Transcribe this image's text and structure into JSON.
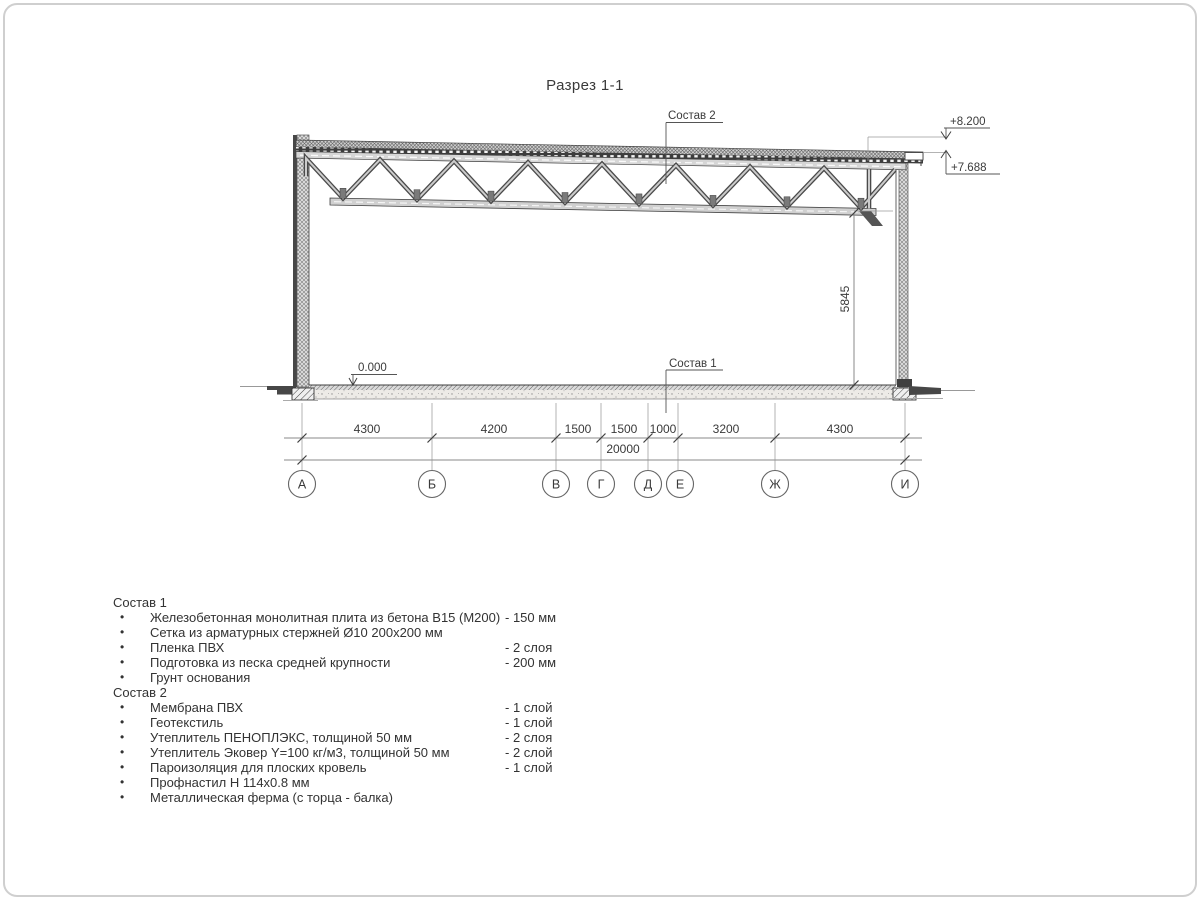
{
  "page": {
    "title": "Разрез 1-1"
  },
  "drawing": {
    "labels": {
      "sostav1_callout": "Состав 1",
      "sostav2_callout": "Состав 2",
      "level_zero": "0.000",
      "level_top": "+8.200",
      "level_roof": "+7.688",
      "height_dim": "5845",
      "total_dim": "20000"
    },
    "dims": [
      "4300",
      "4200",
      "1500",
      "1500",
      "1000",
      "3200",
      "4300"
    ],
    "axes": [
      "А",
      "Б",
      "В",
      "Г",
      "Д",
      "Е",
      "Ж",
      "И"
    ],
    "colors": {
      "line": "#3a3a3a",
      "dim_line": "#8a8a8a",
      "steel": "#4a4a4a"
    }
  },
  "legend": {
    "bullet": "•",
    "sostav1": {
      "header": "Состав 1",
      "items": [
        {
          "text": "Железобетонная монолитная плита из бетона В15 (М200)",
          "value": "-  150 мм"
        },
        {
          "text": "Сетка из арматурных стержней Ø10 200х200 мм",
          "value": ""
        },
        {
          "text": "Пленка ПВХ",
          "value": "-  2 слоя"
        },
        {
          "text": "Подготовка из песка средней крупности",
          "value": "- 200 мм"
        },
        {
          "text": "Грунт основания",
          "value": ""
        }
      ]
    },
    "sostav2": {
      "header": "Состав 2",
      "items": [
        {
          "text": "Мембрана ПВХ",
          "value": "- 1 слой"
        },
        {
          "text": "Геотекстиль",
          "value": "- 1 слой"
        },
        {
          "text": "Утеплитель ПЕНОПЛЭКС, толщиной 50 мм",
          "value": "- 2 слоя"
        },
        {
          "text": "Утеплитель Эковер Y=100 кг/м3, толщиной 50 мм",
          "value": "- 2 слой"
        },
        {
          "text": "Пароизоляция для плоских кровель",
          "value": "- 1 слой"
        },
        {
          "text": "Профнастил Н 114х0.8 мм",
          "value": ""
        },
        {
          "text": "Металлическая ферма (с торца - балка)",
          "value": ""
        }
      ]
    }
  }
}
